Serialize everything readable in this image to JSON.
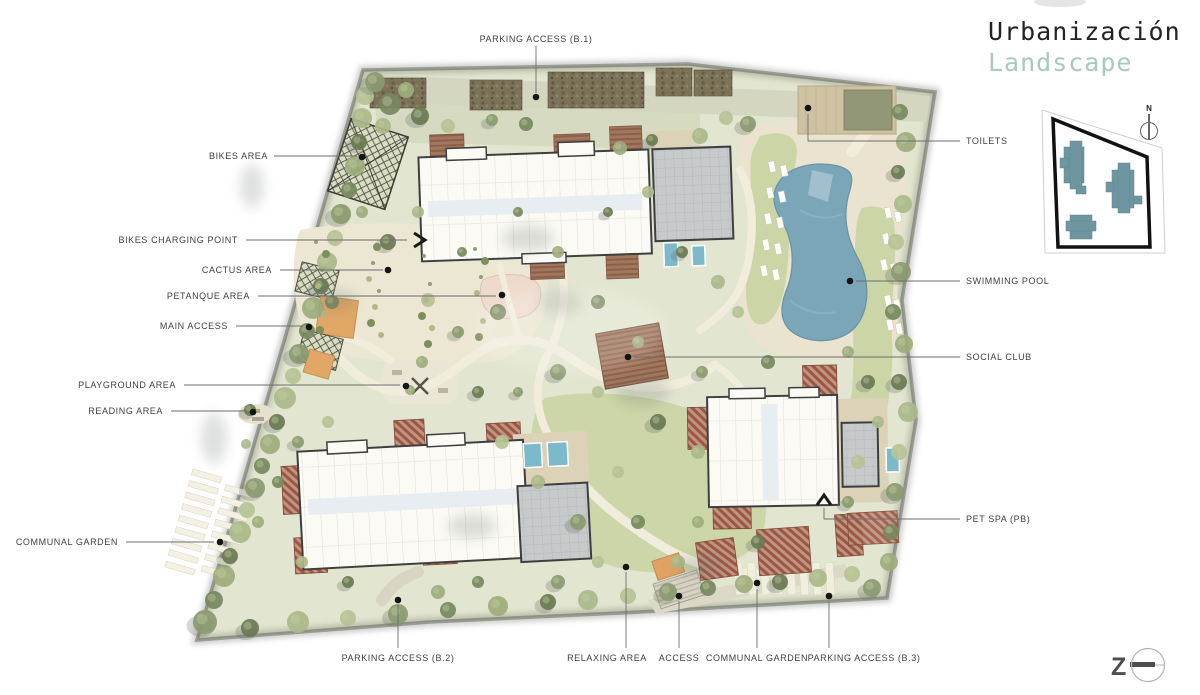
{
  "title": {
    "line1": "Urbanización",
    "line2": "Landscape"
  },
  "annotations": {
    "parking_b1": "PARKING ACCESS (B.1)",
    "bikes_area": "BIKES AREA",
    "bikes_charging": "BIKES CHARGING POINT",
    "cactus": "CACTUS AREA",
    "petanque": "PETANQUE AREA",
    "main_access": "MAIN ACCESS",
    "playground": "PLAYGROUND AREA",
    "reading": "READING AREA",
    "communal_garden_left": "COMMUNAL GARDEN",
    "toilets": "TOILETS",
    "swimming_pool": "SWIMMING POOL",
    "social_club": "SOCIAL CLUB",
    "pet_spa": "PET SPA (PB)",
    "parking_b2": "PARKING ACCESS (B.2)",
    "relaxing": "RELAXING AREA",
    "access": "ACCESS",
    "communal_garden_bottom": "COMMUNAL GARDEN",
    "parking_b3": "PARKING ACCESS (B.3)"
  },
  "keymap": {
    "north": "N"
  },
  "logo": {
    "letter": "Z"
  },
  "colors": {
    "accent_teal": "#a9c8c2",
    "pool_blue": "#7aa6b8",
    "land": "#e2e5cf",
    "lawn": "#cbd5a5",
    "canopy_orange": "#dfa263",
    "roof_gray": "#c6cacb",
    "terrace_red": "#9a5844",
    "keymap_building": "#6f96a0",
    "label_ink": "#3f3f3f"
  }
}
